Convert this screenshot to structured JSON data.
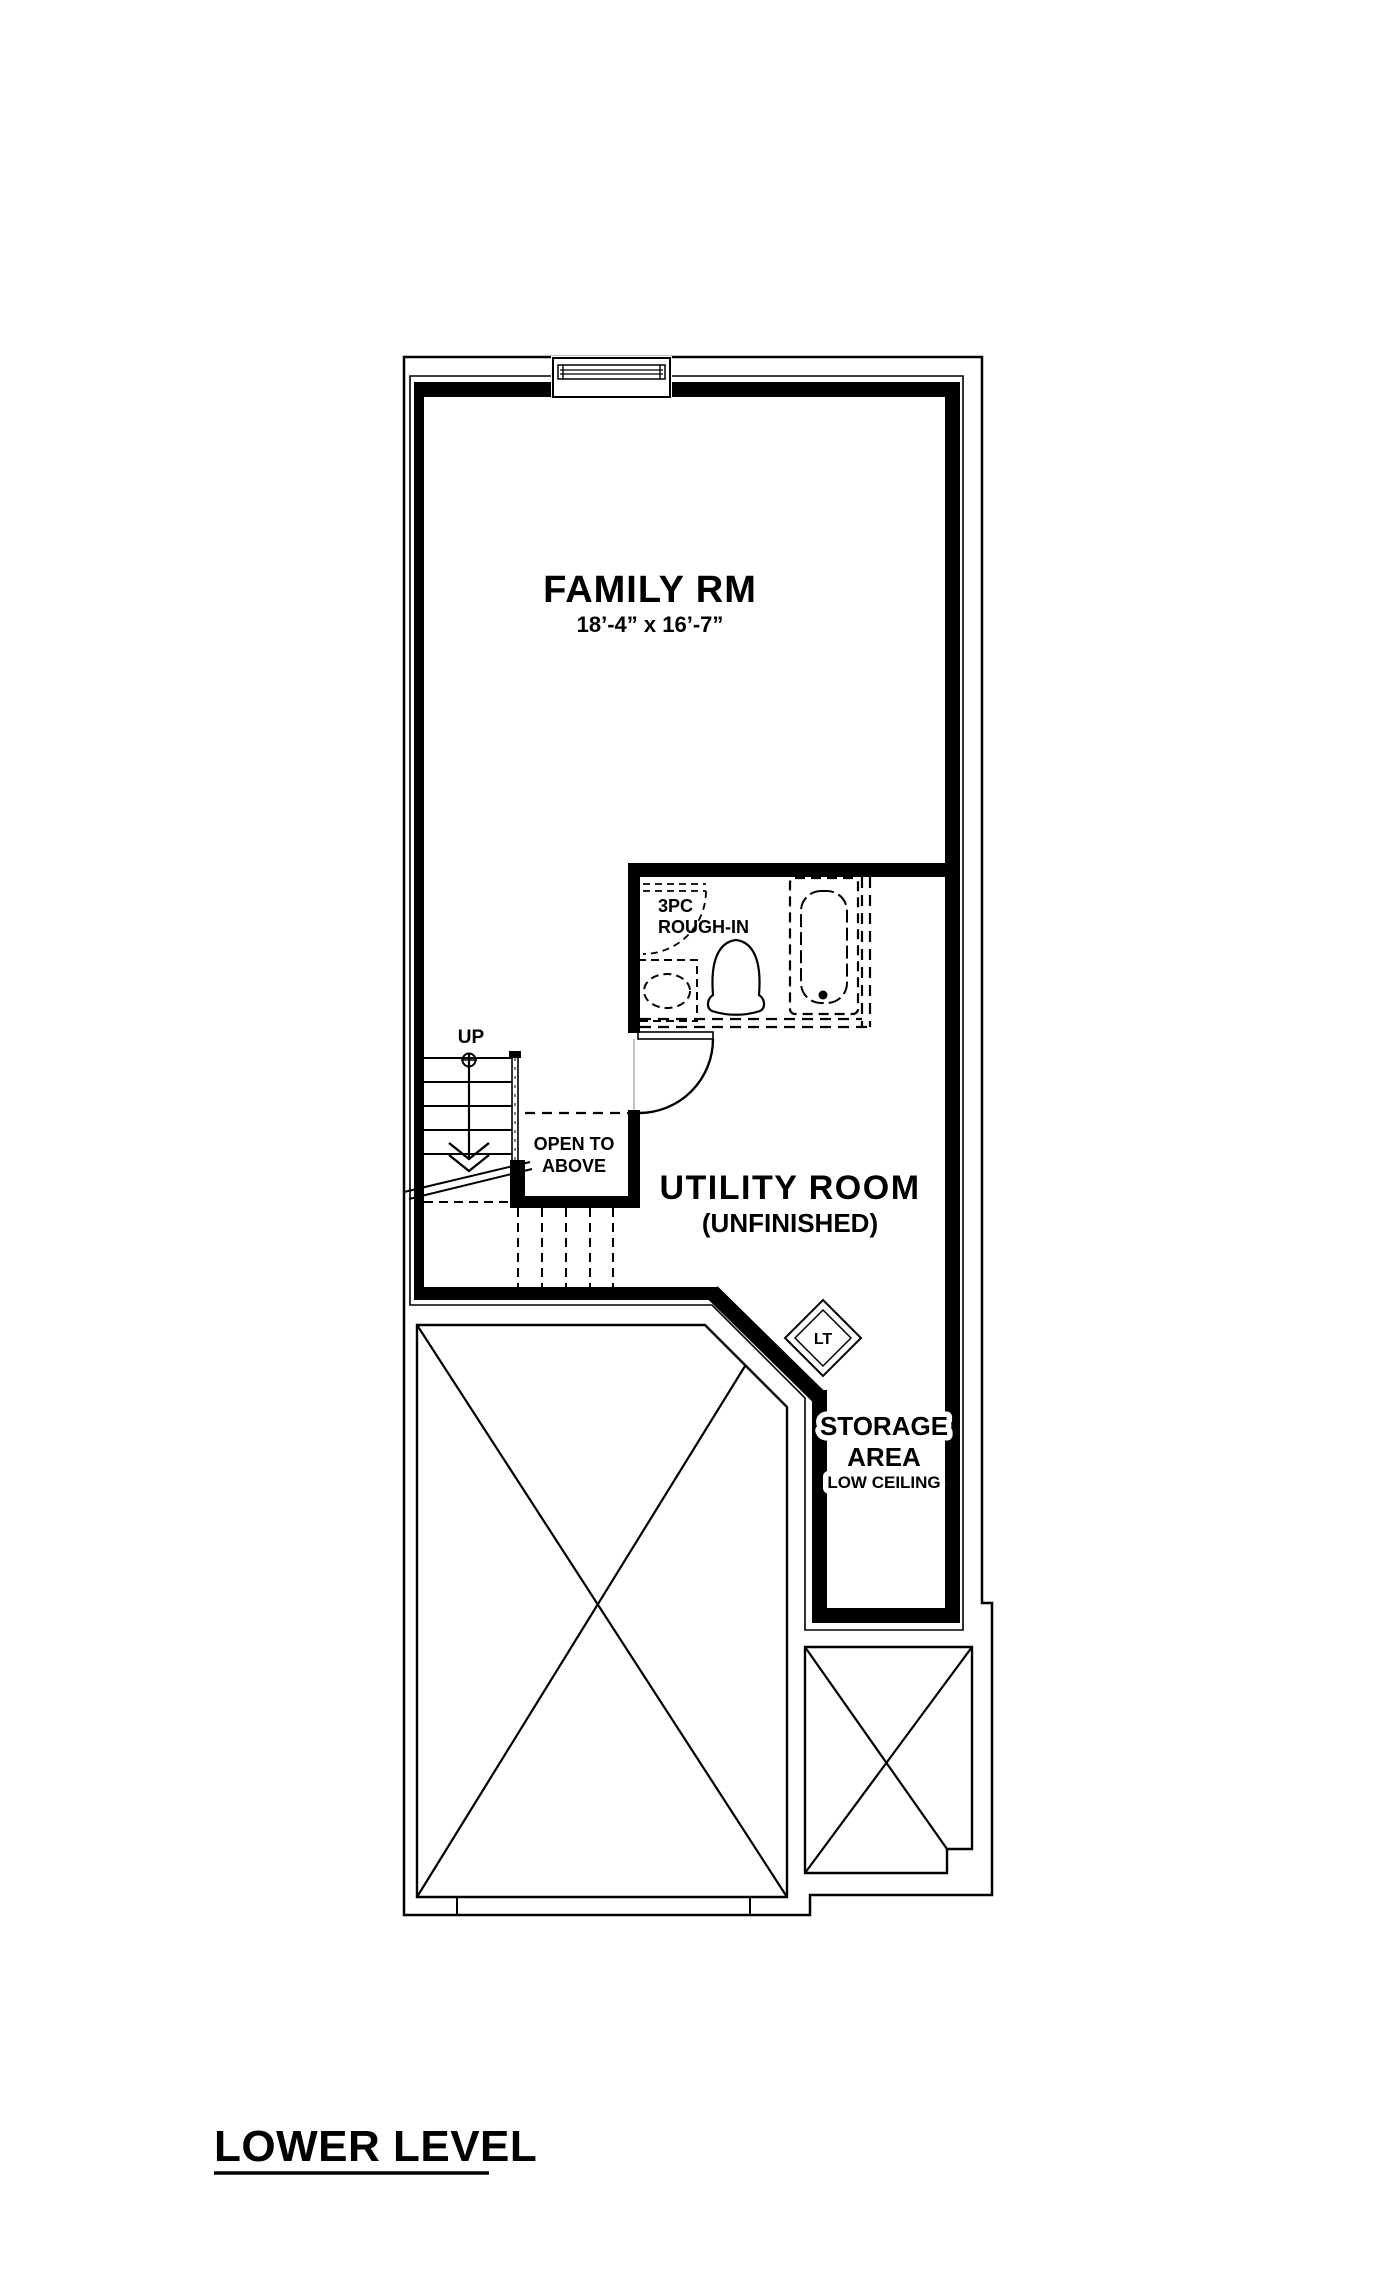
{
  "title": {
    "label": "LOWER LEVEL"
  },
  "colors": {
    "ink": "#000000",
    "paper": "#ffffff"
  },
  "rooms": {
    "family": {
      "name": "FAMILY RM",
      "dimensions": "18’-4” x 16’-7”"
    },
    "utility": {
      "name": "UTILITY ROOM",
      "status": "(UNFINISHED)"
    },
    "storage": {
      "line1": "STORAGE",
      "line2": "AREA",
      "note": "LOW CEILING"
    },
    "bath": {
      "line1": "3PC",
      "line2": "ROUGH-IN"
    }
  },
  "stairs": {
    "up_label": "UP"
  },
  "open_to_above": {
    "line1": "OPEN TO",
    "line2": "ABOVE"
  },
  "fixtures": {
    "laundry_tub": "LT"
  }
}
